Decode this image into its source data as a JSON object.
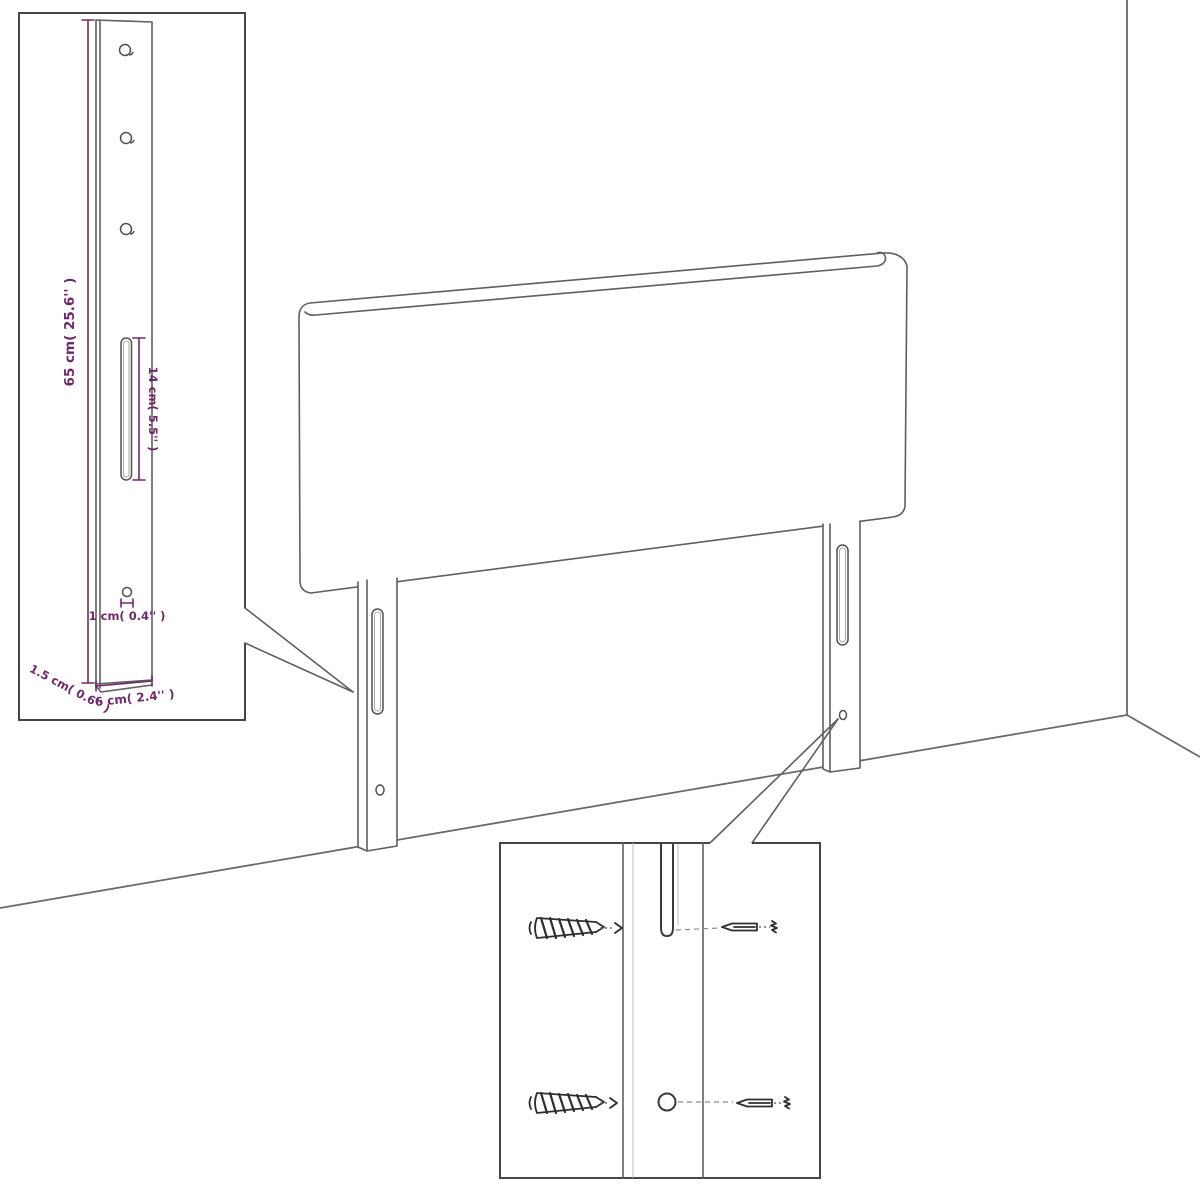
{
  "labels": {
    "height": "65 cm( 25.6'' )",
    "slot_length": "14 cm( 5.5'' )",
    "hole_size": "1 cm( 0.4'' )",
    "thickness": "1.5 cm( 0.6'' )",
    "leg_width": "6 cm( 2.4'' )"
  },
  "colors": {
    "dimension_accent": "#6e2a68",
    "drawing_line": "#5f5f5f",
    "background": "#ffffff"
  }
}
